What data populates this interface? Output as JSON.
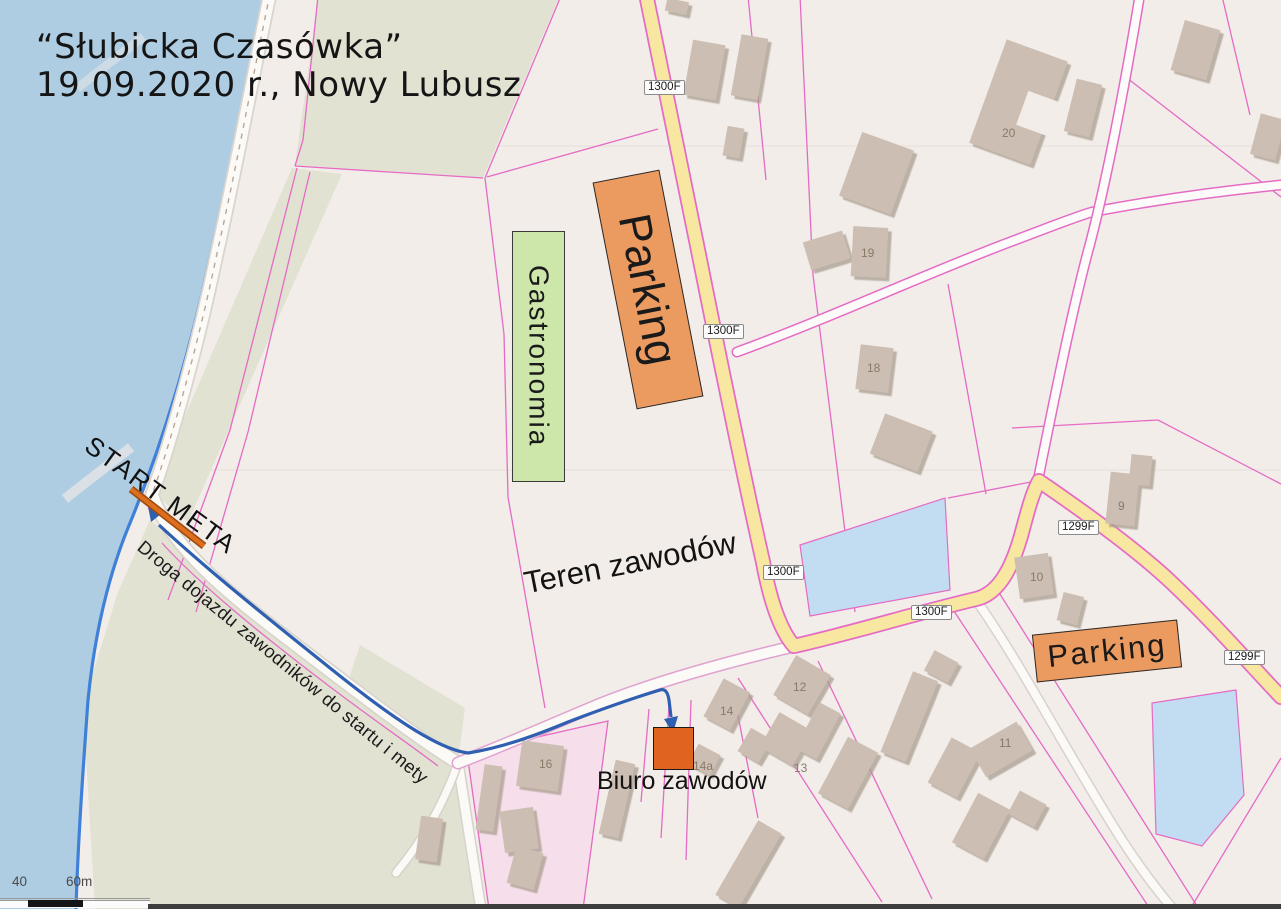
{
  "title": {
    "line1": "“Słubicka Czasówka”",
    "line2": "19.09.2020 r., Nowy Lubusz"
  },
  "labels": {
    "start_meta": "START META",
    "access_road": "Droga dojazdu zawodników do startu i mety",
    "event_area": "Teren zawodów",
    "gastronomy": "Gastronomia",
    "parking_main": "Parking",
    "parking_right": "Parking",
    "race_office": "Biuro zawodów"
  },
  "road_signs": [
    {
      "text": "1300F"
    },
    {
      "text": "1300F"
    },
    {
      "text": "1300F"
    },
    {
      "text": "1300F"
    },
    {
      "text": "1299F"
    },
    {
      "text": "1299F"
    }
  ],
  "building_numbers": [
    {
      "text": "20"
    },
    {
      "text": "19"
    },
    {
      "text": "18"
    },
    {
      "text": "9"
    },
    {
      "text": "10"
    },
    {
      "text": "11"
    },
    {
      "text": "12"
    },
    {
      "text": "13"
    },
    {
      "text": "14"
    },
    {
      "text": "14a"
    },
    {
      "text": "16"
    }
  ],
  "scale": {
    "mid_label": "40",
    "end_label": "60m"
  },
  "colors": {
    "water": "#AFCDE2",
    "river_edge": "#3F80D8",
    "field": "#F2EDE9",
    "grass": "#E2E2D3",
    "parcel_line": "#E56BC5",
    "road_yellow": "#F7E7A0",
    "building": "#CCBEB2",
    "parking_fill": "#EC9B60",
    "gastronomy_fill": "#CDE7AB",
    "office_fill": "#DF6420",
    "route_blue": "#2F5FB1",
    "start_line": "#D2671C",
    "pond": "#C2DCF1",
    "pink_parcel_fill": "#F6DEEA"
  }
}
